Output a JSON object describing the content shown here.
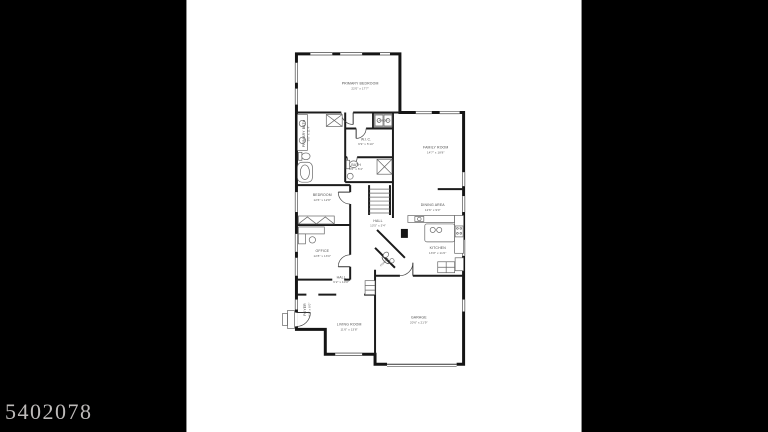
{
  "watermark": "5402078",
  "floorplan": {
    "rooms": {
      "primary_bedroom": {
        "name": "PRIMARY BEDROOM",
        "dims": "22'0\" x 17'7\""
      },
      "family_room": {
        "name": "FAMILY ROOM",
        "dims": "14'7\" x 18'8\""
      },
      "primary_bath": {
        "name": "PRIMARY BATH",
        "dims": "9'6\" x 11'4\""
      },
      "wic": {
        "name": "W.I.C.",
        "dims": "9'9\" x 5'10\""
      },
      "laundry": {
        "name": "LAUNDRY",
        "dims": ""
      },
      "bath": {
        "name": "BATH",
        "dims": "8'6\" x 5'4\""
      },
      "bedroom": {
        "name": "BEDROOM",
        "dims": "12'6\" x 12'8\""
      },
      "hall_upper": {
        "name": "HALL",
        "dims": "13'5\" x 3'4\""
      },
      "office": {
        "name": "OFFICE",
        "dims": "12'8\" x 13'0\""
      },
      "dining_area": {
        "name": "DINING AREA",
        "dims": "12'6\" x 9'0\""
      },
      "kitchen": {
        "name": "KITCHEN",
        "dims": "13'8\" x 11'0\""
      },
      "powder": {
        "name": "POWDER",
        "dims": ""
      },
      "hall_lower": {
        "name": "HALL",
        "dims": "6'2\" x 10'8\""
      },
      "foyer": {
        "name": "FOYER",
        "dims": "6'4\" x 8'0\""
      },
      "living_room": {
        "name": "LIVING ROOM",
        "dims": "11'6\" x 13'8\""
      },
      "garage": {
        "name": "GARAGE",
        "dims": "20'6\" x 21'9\""
      }
    },
    "colors": {
      "frame": "#000000",
      "paper": "#ffffff",
      "walls": "#151515",
      "labels": "#4a4a4a",
      "watermark": "#bdbab9"
    }
  }
}
